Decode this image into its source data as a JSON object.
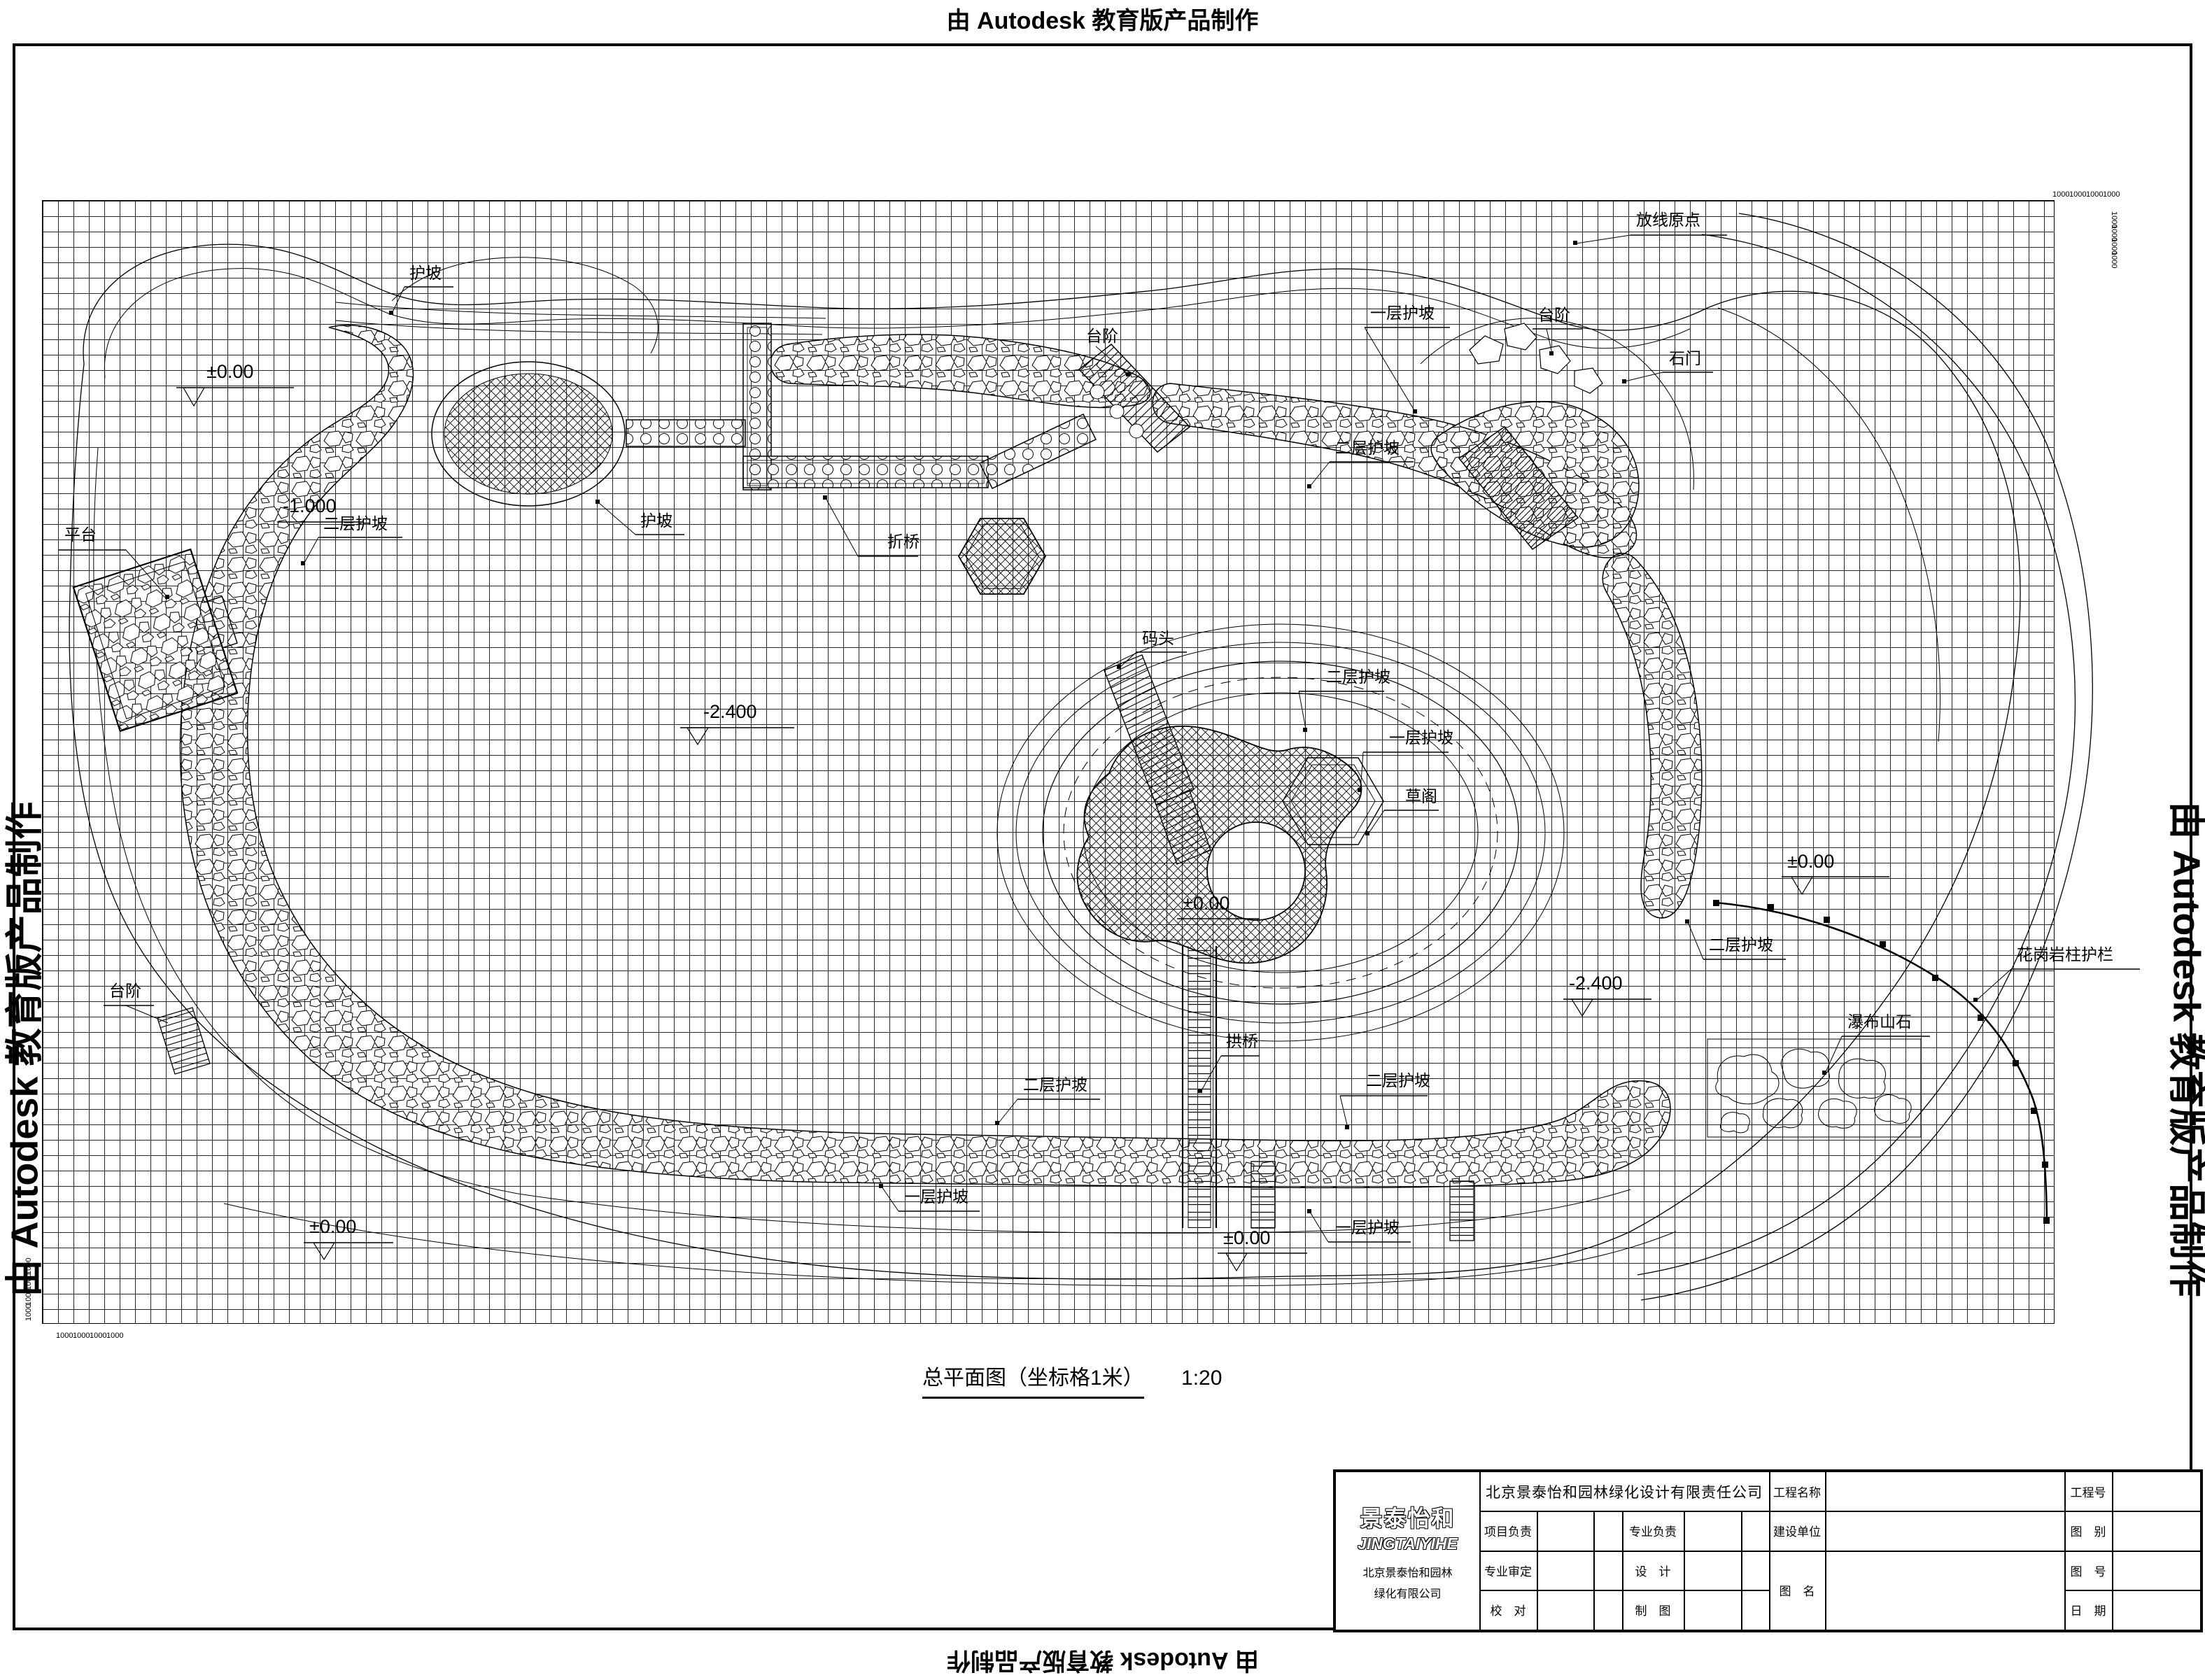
{
  "watermark": {
    "text": "由 Autodesk 教育版产品制作"
  },
  "caption": {
    "title": "总平面图（坐标格1米）",
    "scale_value": "1:20"
  },
  "dims": {
    "d1000": "1000"
  },
  "labels": {
    "origin": "放线原点",
    "slope": "护坡",
    "steps": "台阶",
    "slope_l1": "一层护坡",
    "slope_l2": "二层护坡",
    "stone_gate": "石门",
    "zigzag_bridge": "折桥",
    "platform": "平台",
    "dock": "码头",
    "grass_pavilion": "草阁",
    "arch_bridge": "拱桥",
    "waterfall_rocks": "瀑布山石",
    "granite_railing": "花岗岩柱护栏",
    "elev_zero": "±0.00",
    "elev_neg2400": "-2.400",
    "elev_neg1000": "-1.000"
  },
  "title_block": {
    "logo_cn": "景泰怡和",
    "logo_en": "JINGTAIYIHE",
    "logo_addr1": "北京景泰怡和园林",
    "logo_addr2": "绿化有限公司",
    "company": "北京景泰怡和园林绿化设计有限责任公司",
    "f_project_name": "工程名称",
    "f_project_no": "工程号",
    "f_project_lead": "项目负责",
    "f_discipline_lead": "专业负责",
    "f_client": "建设单位",
    "f_category": "图　别",
    "f_review": "专业审定",
    "f_design": "设　计",
    "f_drawing_name": "图　名",
    "f_drawing_no": "图　号",
    "f_check": "校　对",
    "f_draft": "制　图",
    "f_date": "日　期"
  }
}
